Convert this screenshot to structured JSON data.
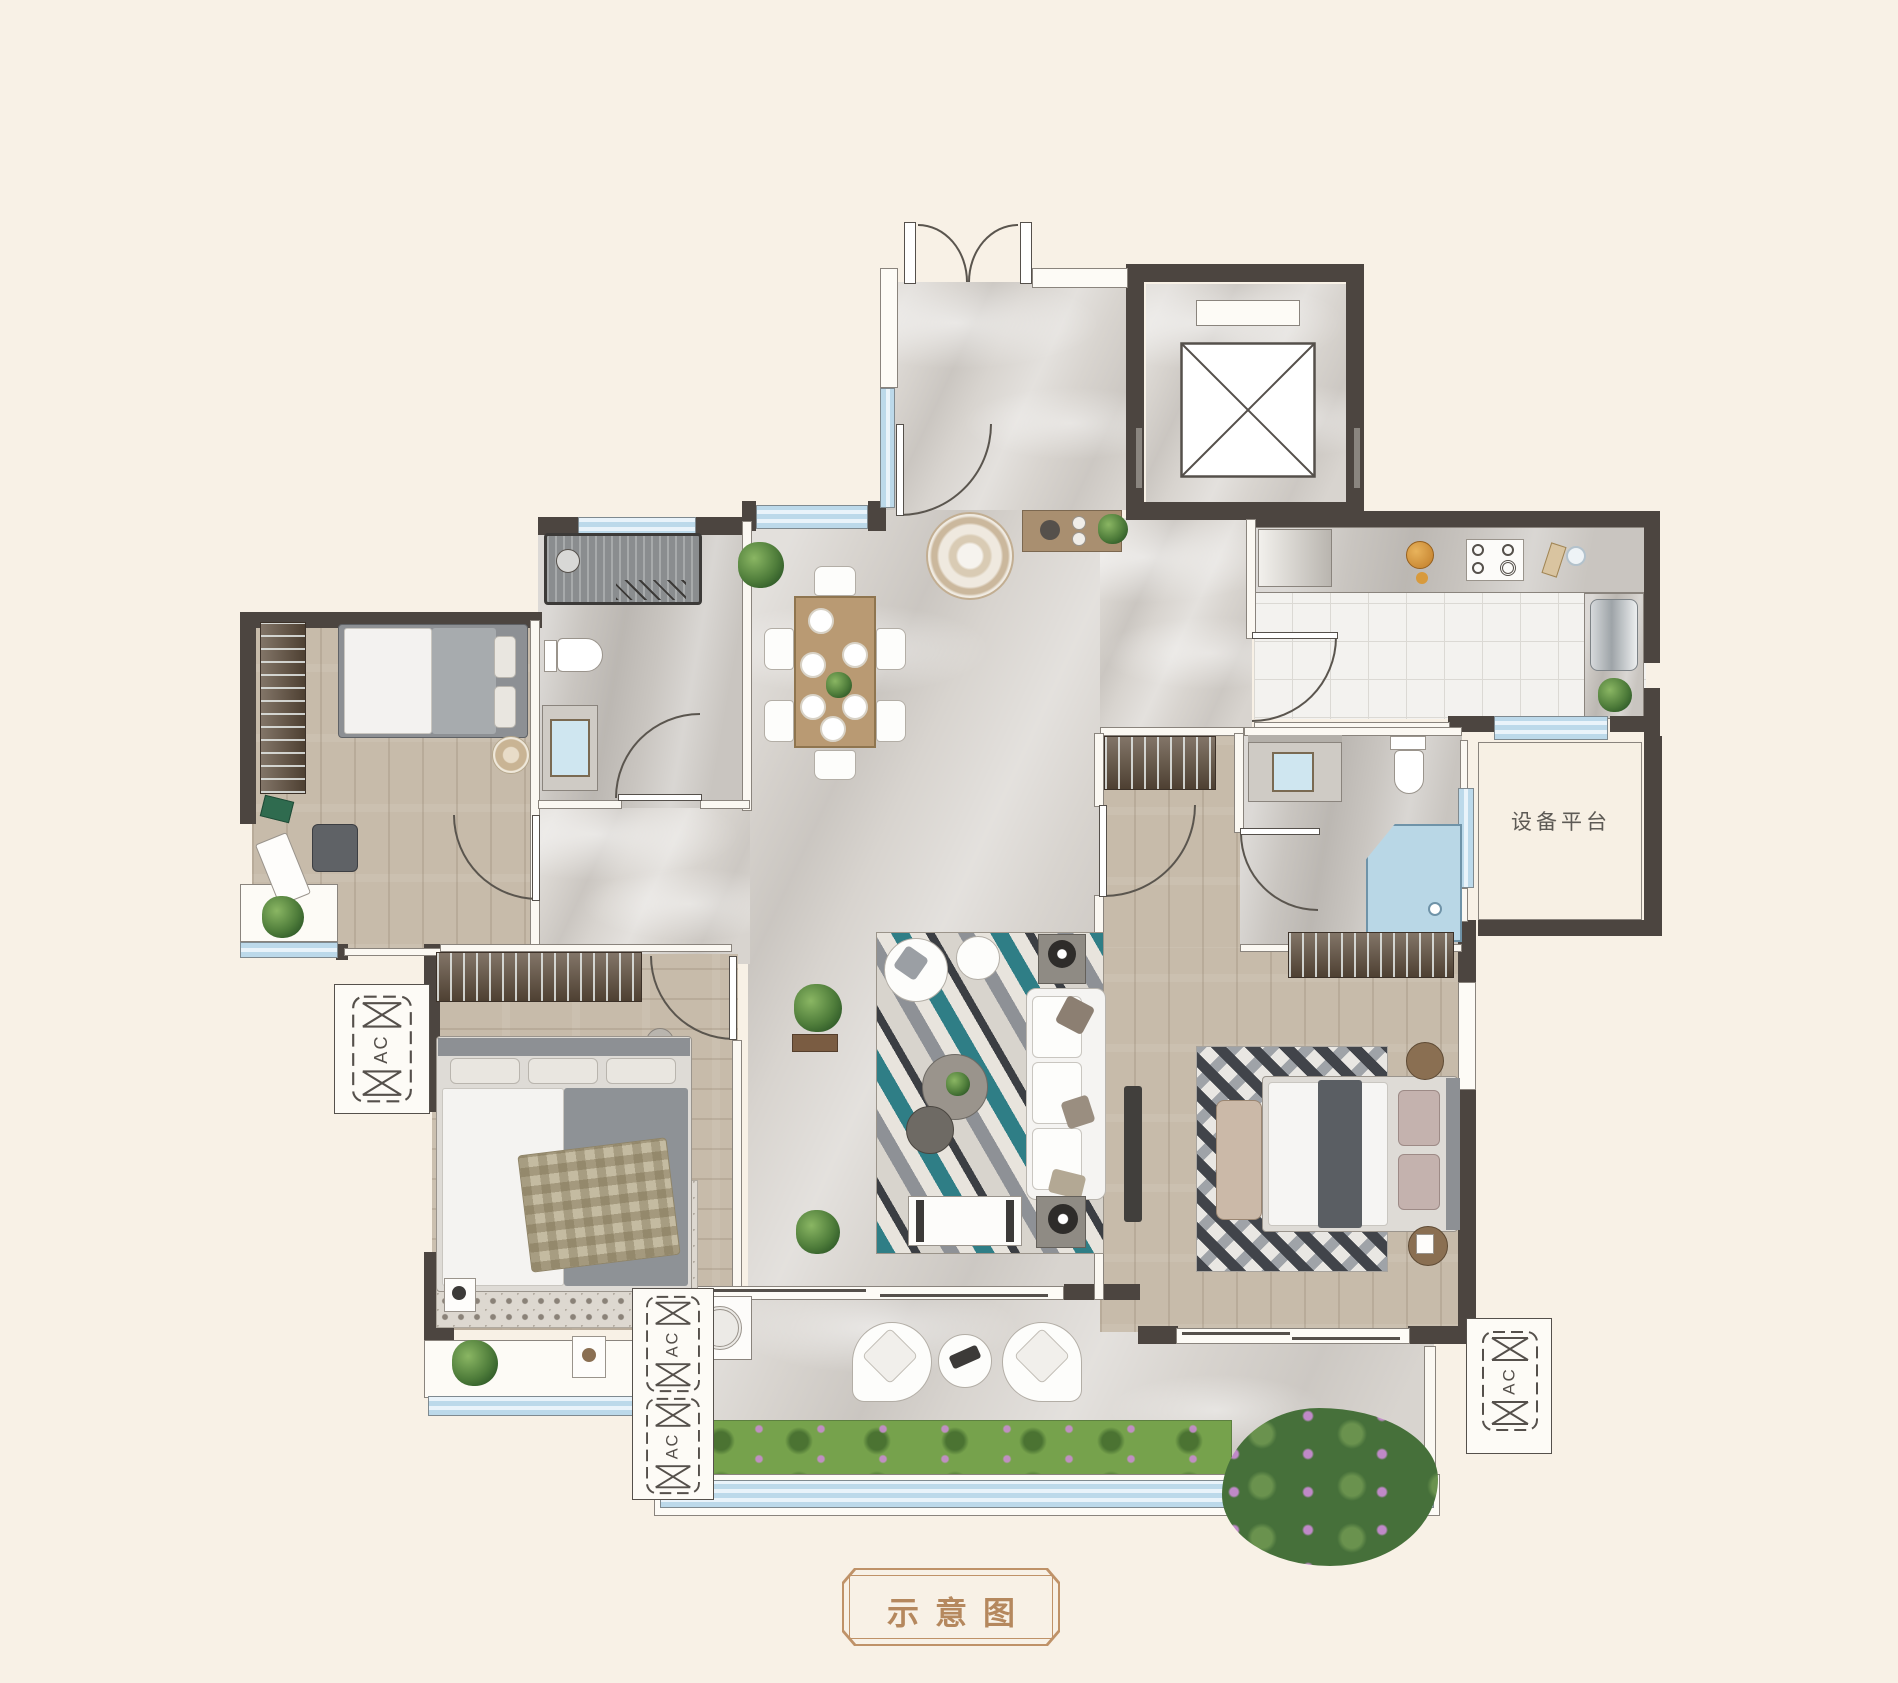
{
  "page": {
    "background": "#f8f1e6"
  },
  "caption": {
    "text": "示意图",
    "color": "#b5885e"
  },
  "labels": {
    "equipment_platform": "设备平台"
  },
  "ac_units": [
    {
      "label": "AC"
    },
    {
      "label": "AC"
    },
    {
      "label": "AC"
    },
    {
      "label": "AC"
    }
  ],
  "palette": {
    "wall": "#4c4540",
    "floor_marble": "#d8d4cf",
    "floor_wood": "#c7bbaa",
    "floor_tile": "#f3f2ef",
    "window_glass": "#cfe4f1",
    "rug_teal": "#2f7e86",
    "grass": "#76a24c",
    "caption_brown": "#b5885e",
    "cream": "#f8f1e6"
  }
}
